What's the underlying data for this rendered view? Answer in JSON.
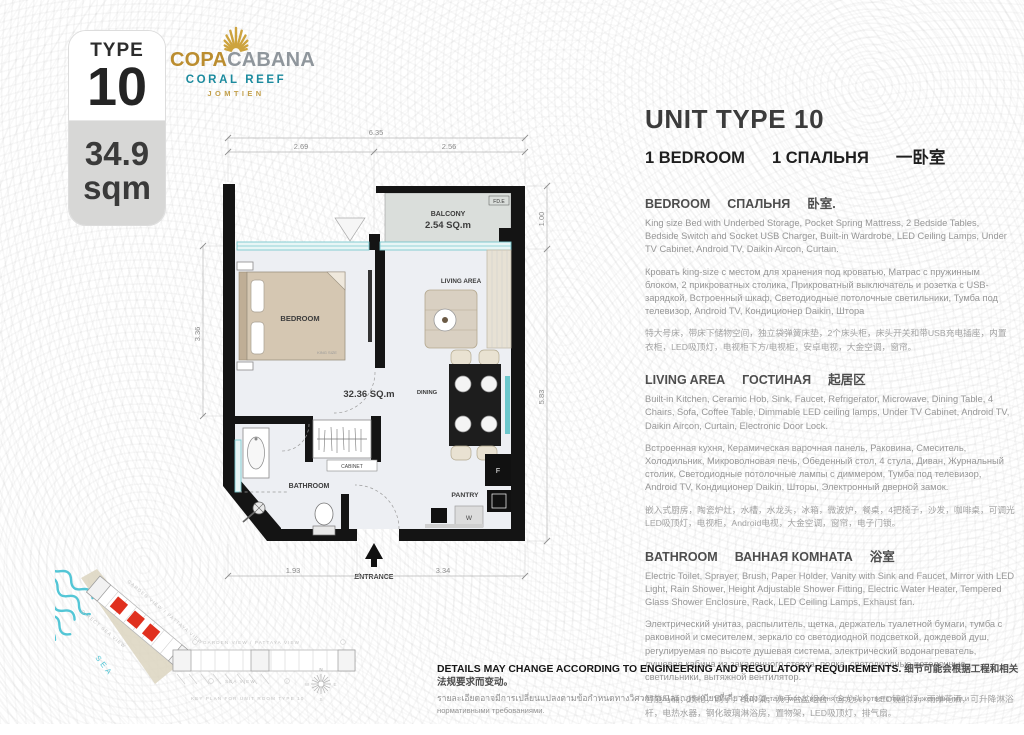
{
  "badge": {
    "type_label": "TYPE",
    "type_number": "10",
    "area_value": "34.9",
    "area_unit": "sqm"
  },
  "logo": {
    "brand_gold": "COPA",
    "brand_silver": "CABANA",
    "subtitle": "CORAL REEF",
    "location": "JOMTIEN"
  },
  "colors": {
    "gold": "#bb8d2f",
    "teal": "#1b8a9e",
    "highlight_red": "#e0301e"
  },
  "info": {
    "title": "UNIT TYPE 10",
    "subtitle_parts": [
      "1 BEDROOM",
      "1 СПАЛЬНЯ",
      "一卧室"
    ],
    "sections": [
      {
        "heading_en": "BEDROOM",
        "heading_ru": "СПАЛЬНЯ",
        "heading_zh": "卧室.",
        "body_en": "King size Bed with Underbed Storage, Pocket Spring Mattress, 2 Bedside Tables, Bedside Switch and Socket USB Charger, Built-in Wardrobe, LED Ceiling Lamps, Under TV Cabinet, Android TV, Daikin Aircon, Curtain.",
        "body_ru": "Кровать king-size с местом для хранения под кроватью, Матрас с пружинным блоком, 2 прикроватных столика, Прикроватный выключатель и розетка с USB-зарядкой, Встроенный шкаф, Светодиодные потолочные светильники, Тумба под телевизор, Android TV, Кондиционер Daikin, Штора",
        "body_zh": "特大号床，带床下储物空间，独立袋弹簧床垫，2个床头柜，床头开关和带USB充电插座，内置衣柜，LED吸顶灯，电视柜下方/电视柜，安卓电视，大金空调，窗帘。"
      },
      {
        "heading_en": "LIVING AREA",
        "heading_ru": "ГОСТИНАЯ",
        "heading_zh": "起居区",
        "body_en": "Built-in Kitchen, Ceramic Hob, Sink, Faucet, Refrigerator, Microwave, Dining Table, 4 Chairs, Sofa, Coffee Table, Dimmable LED ceiling lamps, Under TV Cabinet, Android TV, Daikin Aircon, Curtain, Electronic Door Lock.",
        "body_ru": "Встроенная кухня, Керамическая варочная панель, Раковина, Смеситель, Холодильник, Микроволновая печь, Обеденный стол, 4 стула, Диван, Журнальный столик, Светодиодные потолочные лампы с диммером, Тумба под телевизор, Android TV, Кондиционер Daikin, Шторы, Электронный дверной замок.",
        "body_zh": "嵌入式厨房，陶瓷炉灶，水槽，水龙头，冰箱，微波炉，餐桌，4把椅子，沙发，咖啡桌，可调光LED吸顶灯，电视柜，Android电视，大金空调，窗帘，电子门锁。"
      },
      {
        "heading_en": "BATHROOM",
        "heading_ru": "ВАННАЯ КОМНАТА",
        "heading_zh": "浴室",
        "body_en": "Electric Toilet, Sprayer, Brush, Paper Holder, Vanity with Sink and Faucet, Mirror with LED Light, Rain Shower, Height Adjustable Shower Fitting, Electric Water Heater, Tempered Glass Shower Enclosure, Rack, LED Ceiling Lamps, Exhaust fan.",
        "body_ru": "Электрический унитаз, распылитель, щетка, держатель туалетной бумаги, тумба с раковиной и смесителем, зеркало со светодиодной подсветкой, дождевой душ, регулируемая по высоте душевая система, электрический водонагреватель, душевая кабина из закаленного стекла, полка, светодиодные потолочные светильники, вытяжной вентилятор.",
        "body_zh": "智能马桶，喷枪，刷子，纸巾架，洗手台盆组合（含龙头），LED镜前灯，雨淋花洒，可升降淋浴杆，电热水器，钢化玻璃淋浴房，置物架，LED吸顶灯，排气扇。"
      }
    ]
  },
  "floorplan": {
    "dims": {
      "top_total": "6.35",
      "top_left": "2.69",
      "top_right": "2.56",
      "left": "3.36",
      "right_top": "1.00",
      "right": "5.83",
      "bottom_left": "1.93",
      "bottom_right": "3.34"
    },
    "labels": {
      "balcony": "BALCONY",
      "balcony_area": "2.54 SQ.m",
      "fd": "FD.E",
      "bedroom": "BEDROOM",
      "king": "KING SIZE",
      "living": "LIVING AREA",
      "dining": "DINING",
      "unit_area": "32.36 SQ.m",
      "cabinet": "CABINET",
      "bathroom": "BATHROOM",
      "pantry": "PANTRY",
      "fridge": "F",
      "washer": "W",
      "entrance": "ENTRANCE"
    }
  },
  "keyplan": {
    "direct_sea_view": "DIRECT SEA VIEW",
    "garden_view": "GARDEN VIEW / PATTAYA VIEW",
    "sea_view": "SEA VIEW",
    "sea": "SEA",
    "caption": "KEY PLAN FOR UNIT ROOM TYPE 10",
    "compass": {
      "n": "N",
      "e": "E",
      "s": "S",
      "w": "W"
    }
  },
  "disclaimer": {
    "line1_en": "DETAILS MAY CHANGE ACCORDING TO ENGINEERING AND REGULATORY REQUIREMENTS.",
    "line1_zh": "细节可能会根据工程和相关法规要求而变动。",
    "line2_th": "รายละเอียดอาจมีการเปลี่ยนแปลงตามข้อกำหนดทางวิศวกรรมและกฎระเบียบที่เกี่ยวข้อง",
    "line2_ru": "Детали могут изменяться в соответствии с инженерными и нормативными требованиями."
  }
}
